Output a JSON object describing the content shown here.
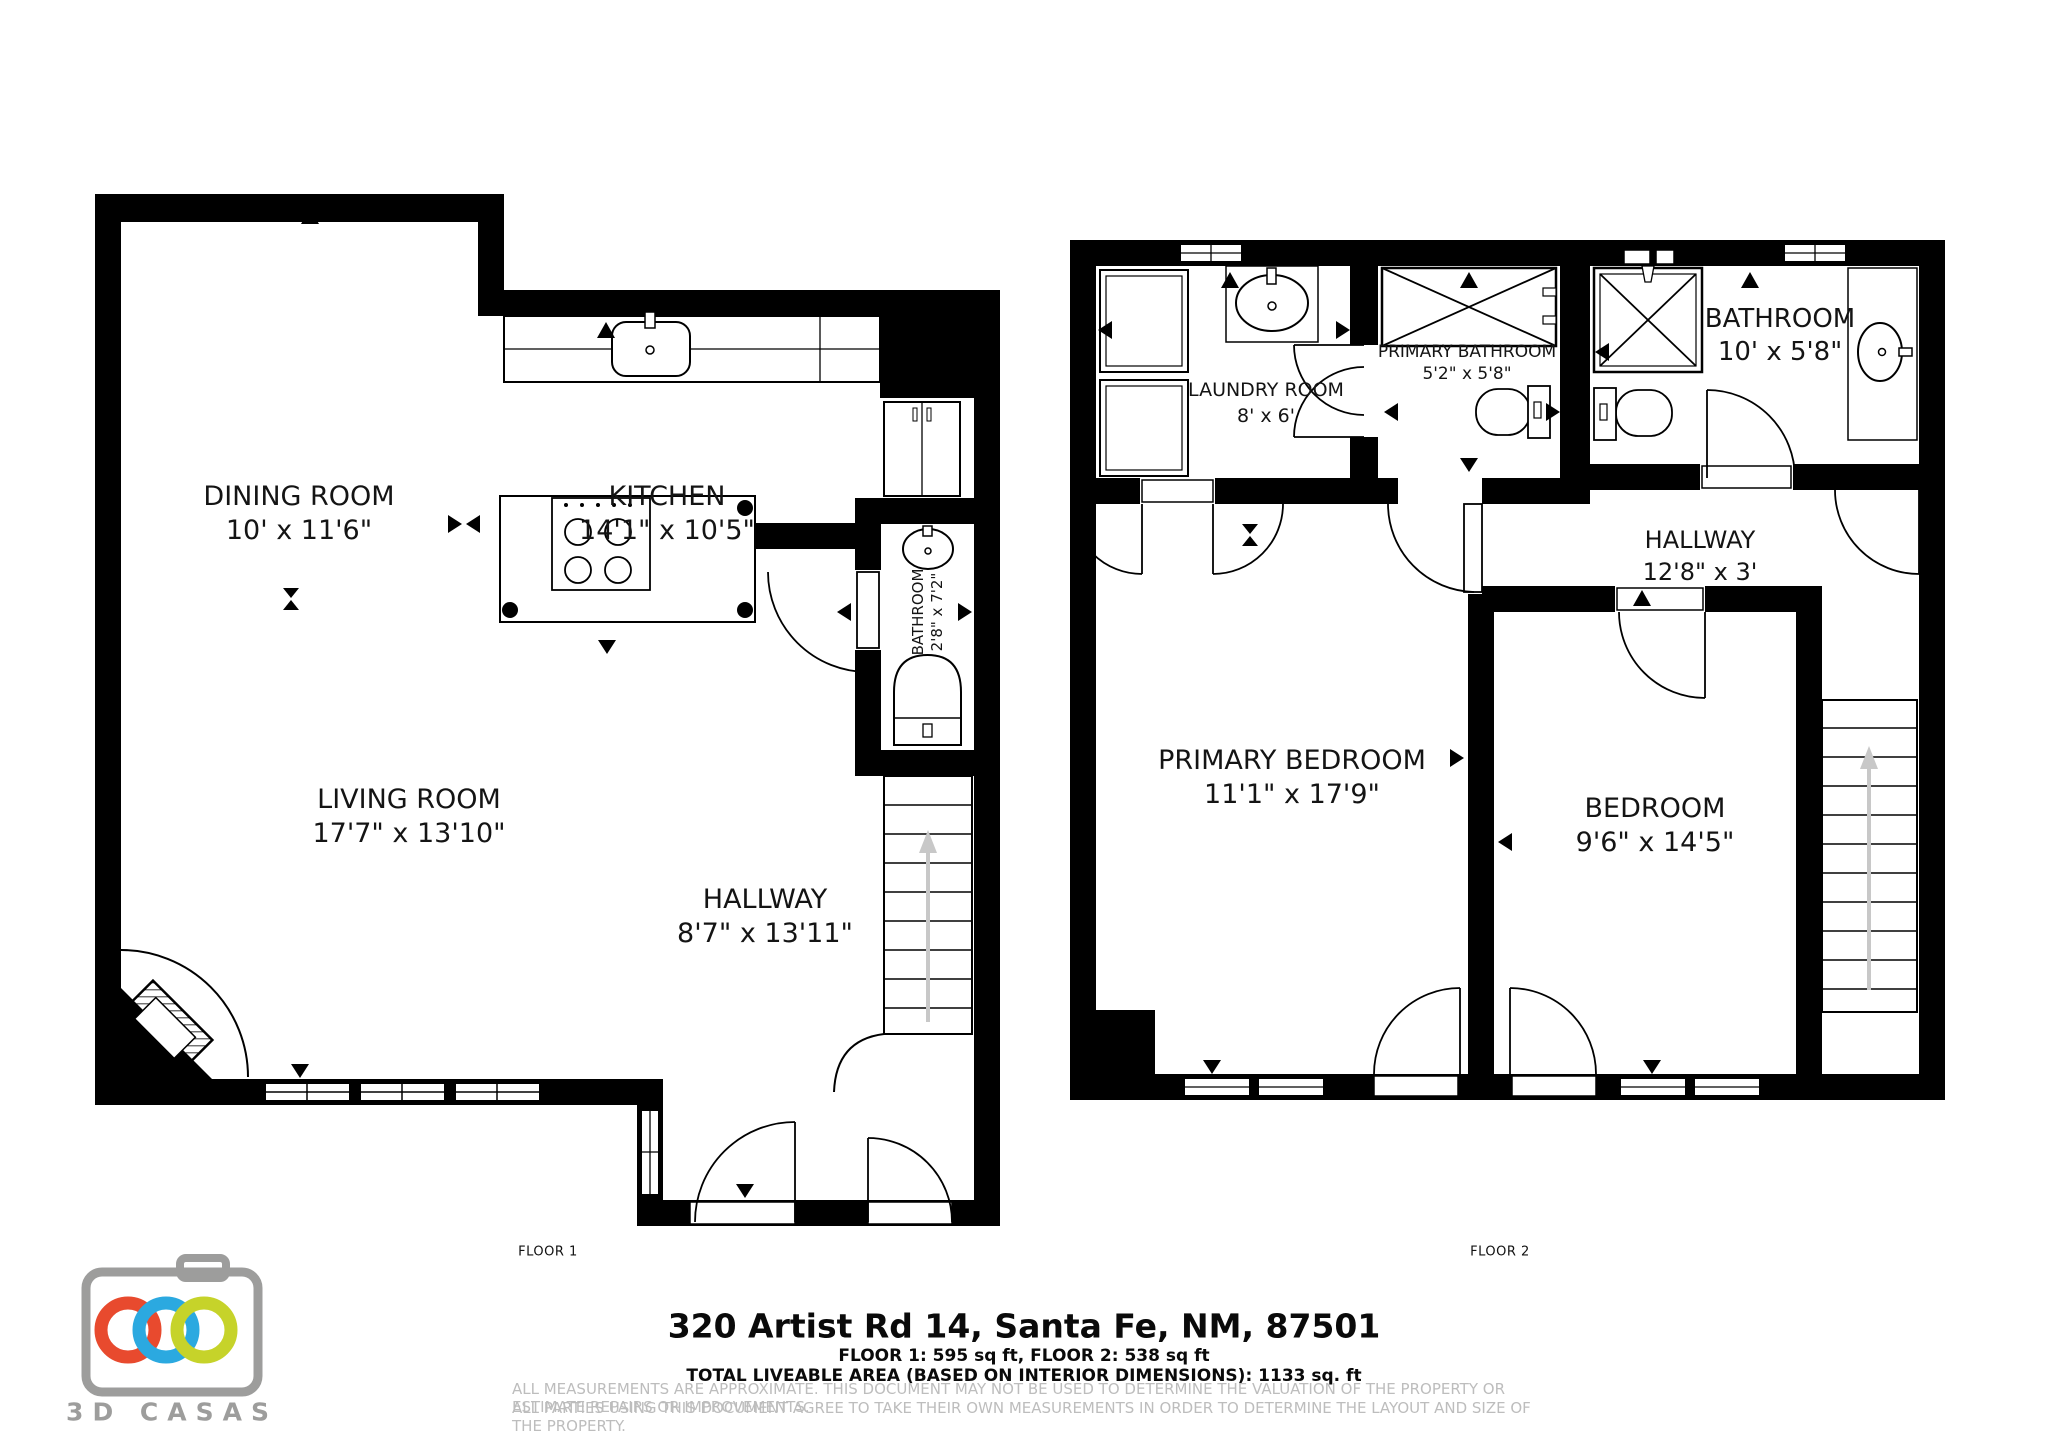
{
  "floor1": {
    "caption": "FLOOR 1",
    "rooms": {
      "dining": {
        "name": "DINING ROOM",
        "dims": "10' x 11'6\""
      },
      "kitchen": {
        "name": "KITCHEN",
        "dims": "14'1\" x 10'5\""
      },
      "bathroom": {
        "name": "BATHROOM",
        "dims": "2'8\" x 7'2\""
      },
      "living": {
        "name": "LIVING ROOM",
        "dims": "17'7\" x 13'10\""
      },
      "hallway": {
        "name": "HALLWAY",
        "dims": "8'7\" x 13'11\""
      }
    }
  },
  "floor2": {
    "caption": "FLOOR 2",
    "rooms": {
      "laundry": {
        "name": "LAUNDRY ROOM",
        "dims": "8' x 6'"
      },
      "primary_bathroom": {
        "name": "PRIMARY BATHROOM",
        "dims": "5'2\" x 5'8\""
      },
      "bathroom": {
        "name": "BATHROOM",
        "dims": "10' x 5'8\""
      },
      "hallway": {
        "name": "HALLWAY",
        "dims": "12'8\" x 3'"
      },
      "primary_bedroom": {
        "name": "PRIMARY BEDROOM",
        "dims": "11'1\" x 17'9\""
      },
      "bedroom": {
        "name": "BEDROOM",
        "dims": "9'6\" x 14'5\""
      }
    }
  },
  "footer": {
    "address": "320 Artist Rd 14, Santa Fe, NM, 87501",
    "floor_areas": "FLOOR 1: 595 sq ft, FLOOR 2: 538 sq ft",
    "total_area": "TOTAL LIVEABLE AREA (BASED ON INTERIOR DIMENSIONS): 1133 sq. ft",
    "disclaimer_line1": "ALL MEASUREMENTS ARE APPROXIMATE. THIS DOCUMENT MAY NOT BE USED TO DETERMINE THE VALUATION OF THE PROPERTY OR ESTIMATE REPAIRS OR IMPROVEMENTS.",
    "disclaimer_line2": "ALL PARTIES USING THIS DOCUMENT AGREE TO TAKE THEIR OWN MEASUREMENTS IN ORDER TO DETERMINE THE LAYOUT AND SIZE OF THE PROPERTY."
  },
  "logo": {
    "text": "3D CASAS",
    "body_color": "#9d9d9c",
    "ring_colors": {
      "left": "#e84a2e",
      "middle": "#2ba9e0",
      "right": "#c6d32a"
    }
  }
}
